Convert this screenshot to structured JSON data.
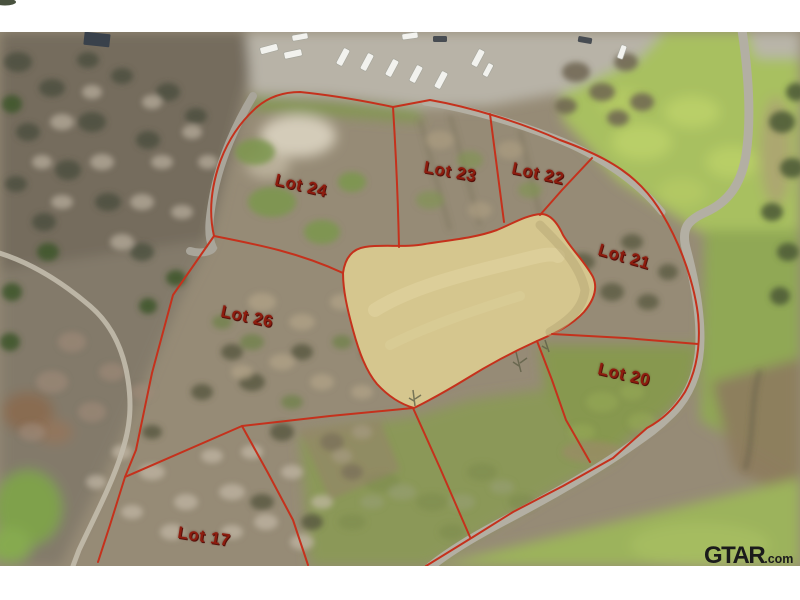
{
  "image_type": "aerial-lot-plat-photo",
  "lots": [
    {
      "label": "Lot 24",
      "x": 301,
      "y": 186,
      "rotation": 13
    },
    {
      "label": "Lot 23",
      "x": 450,
      "y": 172,
      "rotation": 10
    },
    {
      "label": "Lot 22",
      "x": 538,
      "y": 174,
      "rotation": 12
    },
    {
      "label": "Lot 21",
      "x": 624,
      "y": 257,
      "rotation": 16
    },
    {
      "label": "Lot 20",
      "x": 624,
      "y": 375,
      "rotation": 13
    },
    {
      "label": "Lot 26",
      "x": 247,
      "y": 317,
      "rotation": 12
    },
    {
      "label": "Lot 17",
      "x": 204,
      "y": 537,
      "rotation": 9
    }
  ],
  "watermark": {
    "brand": "GTAR",
    "suffix": ".com"
  },
  "colors": {
    "boundary": "#c5311c",
    "label": "#8e1c0e",
    "pond": "#d5c68e",
    "watermark": "#1b1b1b",
    "road": "#b3afa3"
  }
}
